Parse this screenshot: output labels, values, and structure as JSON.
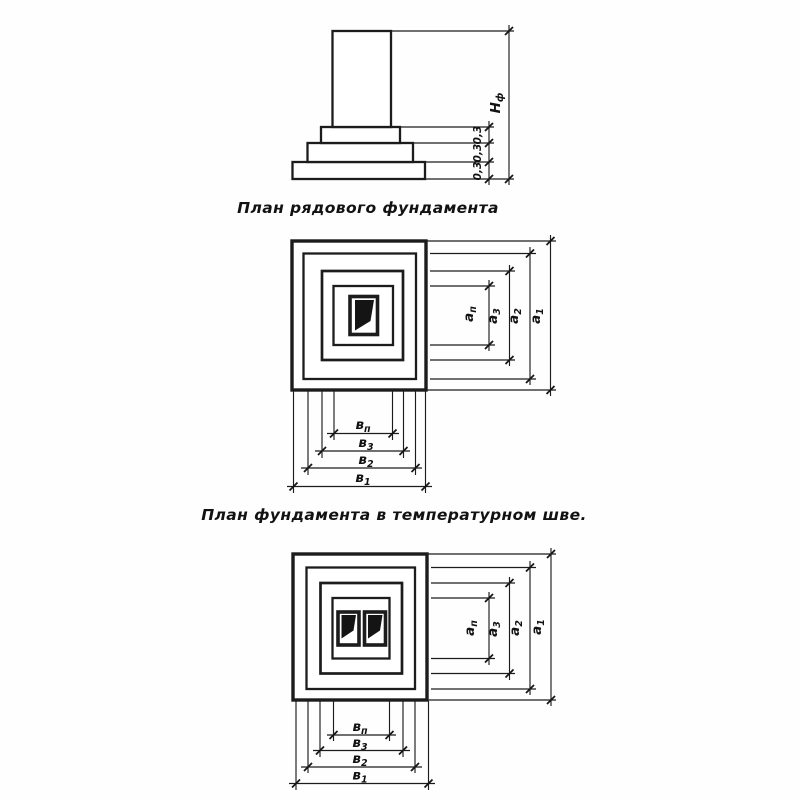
{
  "drawing": {
    "ink_color": "#1c1c1c",
    "paper_color": "#fefefe"
  },
  "elevation": {
    "step_dims": [
      "0,3",
      "0,3",
      "0,3"
    ],
    "height_label": {
      "base": "Н",
      "sub": "ф"
    }
  },
  "plan_row": {
    "caption": "План рядового фундамента",
    "dims_right": [
      {
        "base": "а",
        "sub": "п"
      },
      {
        "base": "а",
        "sub": "3"
      },
      {
        "base": "а",
        "sub": "2"
      },
      {
        "base": "а",
        "sub": "1"
      }
    ],
    "dims_bottom": [
      {
        "base": "в",
        "sub": "п"
      },
      {
        "base": "в",
        "sub": "3"
      },
      {
        "base": "в",
        "sub": "2"
      },
      {
        "base": "в",
        "sub": "1"
      }
    ]
  },
  "plan_joint": {
    "caption": "План фундамента в температурном шве.",
    "dims_right": [
      {
        "base": "а",
        "sub": "п"
      },
      {
        "base": "а",
        "sub": "3"
      },
      {
        "base": "а",
        "sub": "2"
      },
      {
        "base": "а",
        "sub": "1"
      }
    ],
    "dims_bottom": [
      {
        "base": "в",
        "sub": "п"
      },
      {
        "base": "в",
        "sub": "3"
      },
      {
        "base": "в",
        "sub": "2"
      },
      {
        "base": "в",
        "sub": "1"
      }
    ]
  }
}
